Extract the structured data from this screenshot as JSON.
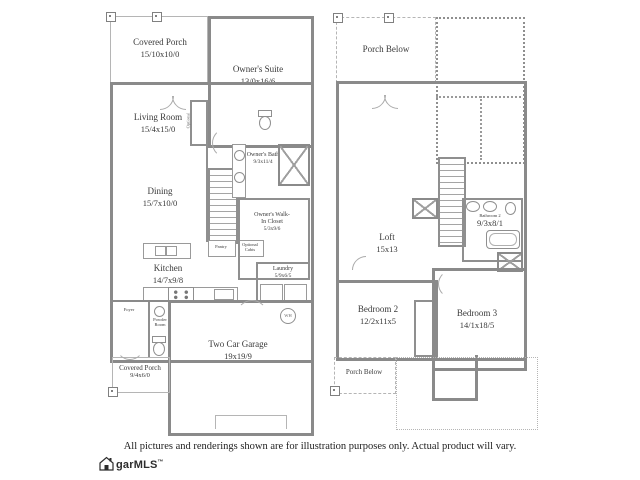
{
  "colors": {
    "wall": "#8a8a8a",
    "wall_light": "#b5b5b5",
    "text": "#3a3a3a",
    "background": "#ffffff"
  },
  "floor1": {
    "rooms": {
      "covered_porch_top": {
        "name": "Covered Porch",
        "dims": "15/10x10/0"
      },
      "owners_suite": {
        "name": "Owner's Suite",
        "dims": "13/0x16/6"
      },
      "living_room": {
        "name": "Living Room",
        "dims": "15/4x15/0"
      },
      "dining": {
        "name": "Dining",
        "dims": "15/7x10/0"
      },
      "owners_bath": {
        "name": "Owner's Bath",
        "dims": "9/3x11/4"
      },
      "walk_in_closet": {
        "name": "Owner's Walk-In Closet",
        "dims": "5/3x9/6"
      },
      "kitchen": {
        "name": "Kitchen",
        "dims": "14/7x9/8"
      },
      "laundry": {
        "name": "Laundry",
        "dims": "5/9x6/5"
      },
      "foyer": {
        "name": "Foyer"
      },
      "powder_room": {
        "name": "Powder Room"
      },
      "garage": {
        "name": "Two Car Garage",
        "dims": "19x19/9"
      },
      "covered_porch_bottom": {
        "name": "Covered Porch",
        "dims": "9/4x6/0"
      }
    },
    "annotations": {
      "pantry": "Pantry",
      "optional_cabinets": "Optional Cabts",
      "optional_fireplace": "Optional",
      "water_heater": "WH"
    }
  },
  "floor2": {
    "rooms": {
      "porch_below_top": {
        "name": "Porch Below"
      },
      "loft": {
        "name": "Loft",
        "dims": "15x13"
      },
      "bathroom2": {
        "name": "Bathroom 2",
        "dims": "9/3x8/1"
      },
      "bedroom2": {
        "name": "Bedroom 2",
        "dims": "12/2x11x5"
      },
      "bedroom3": {
        "name": "Bedroom 3",
        "dims": "14/1x18/5"
      },
      "porch_below_bottom": {
        "name": "Porch Below"
      }
    }
  },
  "footer": {
    "disclaimer": "All pictures and renderings shown are for illustration purposes only. Actual product will vary.",
    "logo": {
      "text": "garMLS",
      "tm": "™"
    }
  }
}
